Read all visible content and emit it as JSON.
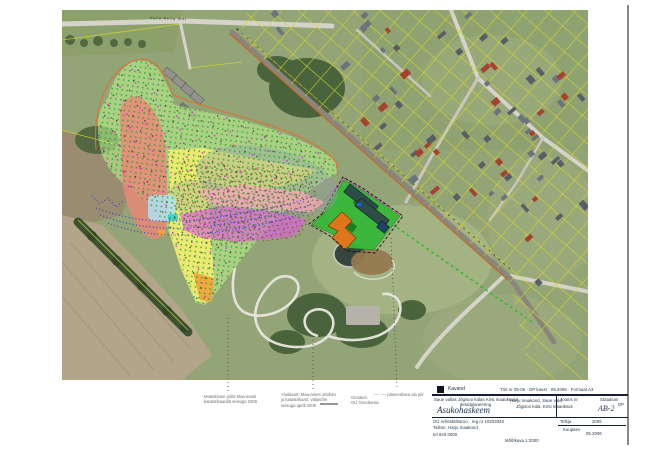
{
  "palette": {
    "navy": "#223249",
    "annot": "#6e6e6e",
    "grass": "#93a476",
    "grass2": "#9fae7f",
    "grass3": "#8ca06c",
    "lawn": "#a8b787",
    "tan": "#b3a58a",
    "tan2": "#9a8c70",
    "stria": "#a2947a",
    "wood": "#46603a",
    "treerow": "#3d5233",
    "roadlight": "#d6d3cb",
    "roadmid": "#c9c6be",
    "hw": "#8a867e",
    "hwline": "#c86a20",
    "cadline": "#e07030",
    "yellow": "#d8d826",
    "shed": "#94928c",
    "house_gray": "#6e727b",
    "house_dark": "#595d66",
    "house_red": "#a8402e",
    "blob": "#b9ee8e",
    "salmon": "#e88878",
    "yband": "#f6ef6e",
    "grayov": "#8fa0a8",
    "pink": "#f4aab8",
    "magenta": "#e25ce2",
    "lblue": "#aee0f2",
    "cyan": "#35d0c8",
    "orange": "#f0a23c",
    "dotgreen": "#1fa01f",
    "dotblack": "#222222",
    "dotmag": "#e020e0",
    "dotbrown": "#7a5a22",
    "blue": "#2838c8",
    "sitegreen": "#38b838",
    "sitedark": "#1e7a1e",
    "teal": "#2e4d48",
    "darkblue": "#24406a",
    "sorange": "#e0761c",
    "pond": "#36463e",
    "dirt": "#96794e",
    "park": "#b5b2aa"
  },
  "map": {
    "road_label": "Vana-Keila mnt"
  },
  "annotations": {
    "note1": [
      "Maaüksuse piirid Maa-ameti",
      "katastrikaardilt seisuga 2006"
    ],
    "note2": [
      "Aluskaart: Maa-ameti ortofoto",
      "ja katastrikaart, väljavõte",
      "seisuga aprill 2006"
    ],
    "note3": [
      "Geoalus:",
      "OÜ Geodeesia"
    ],
    "note4": "— · — planeeritava ala piir"
  },
  "titleblock": {
    "brand": "Kavand",
    "row1_right": "Töö nr 05-05 · DP kaust · 05.2006 · Formaat A3",
    "proj_line1": "Saue vallas Jõgisoo külas Kirsi maaüksuse",
    "proj_line2": "detailplaneering",
    "title": "Asukohaskeem",
    "center_line1": "Harju maakond, Saue vald",
    "center_line2": "Jõgisoo küla, Kirsi maaüksus",
    "sheet_label": "Joonis nr",
    "stage_label": "Staadium",
    "stage_value": "DP",
    "sheet_no": "AB-2",
    "under_label": "Tellija",
    "under_value": "2006",
    "firm1": "OÜ Arhitektibüroo · reg nr 10203040",
    "firm2": "Tallinn, Harju maakond",
    "firm3": "tel 640 0000",
    "client2_label": "Kuupäev",
    "client2_value": "05.2006",
    "footer_center": "Mõõtkava 1:2000"
  }
}
